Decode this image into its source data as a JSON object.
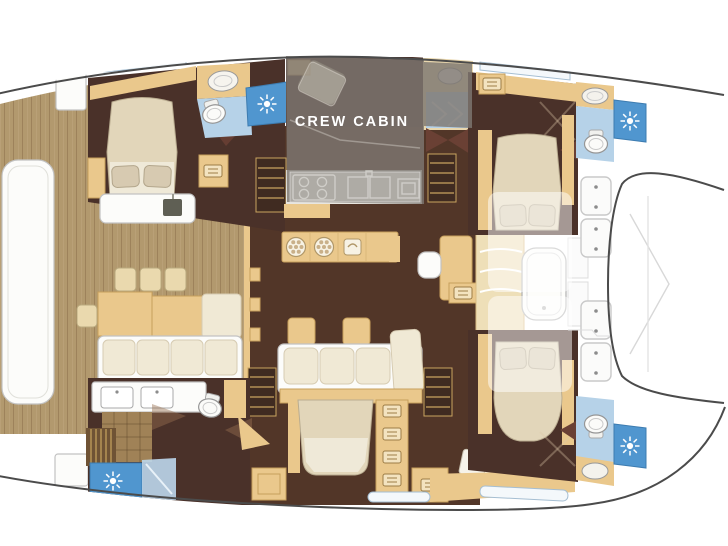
{
  "labels": {
    "crew_cabin": "CREW CABIN"
  },
  "palette": {
    "hull_outline": "#4b4b4b",
    "wood_deck": "#b2996e",
    "cabin_floor": "#4a3129",
    "salon_floor": "#523628",
    "furniture_tan": "#eac88c",
    "upholstery_cream": "#f0e9d5",
    "bed_linen": "#e2d6ba",
    "shower_blue": "#5096cf",
    "tile_blue": "#b6d2e8",
    "overlay_gray": "rgba(126,120,113,0.82)",
    "label_text": "#ffffff"
  },
  "icons": {
    "shower": "sun-burst-icon",
    "drawers": "drawer-lines-icon",
    "sink": "oval-basin-icon",
    "toilet": "oval-toilet-icon",
    "stove": "four-burner-icon",
    "hatch": "deck-hatch-icon"
  }
}
